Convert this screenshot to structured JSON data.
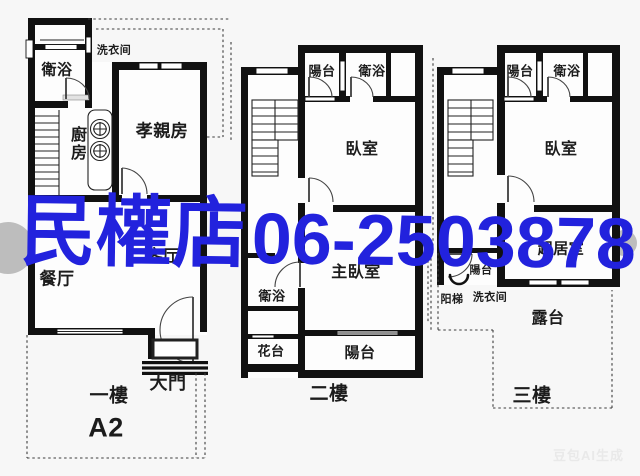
{
  "palette": {
    "wall": "#111111",
    "background": "#f7f7f7",
    "room": "#fdfdfd",
    "watermark_blue": "#2222dd",
    "ai_badge_gray": "#e9e9e9"
  },
  "watermark": {
    "store": "民權店",
    "phone": "06-2503878",
    "color": "#2222dd"
  },
  "ai_badge": {
    "text": "豆包AI生成"
  },
  "floors": [
    {
      "title": "一樓",
      "unit": "A2",
      "rooms": {
        "laundry": "洗衣间",
        "bath": "衛浴",
        "kitchen": "廚房",
        "parents_room": "孝親房",
        "living": "客厅",
        "dining": "餐厅",
        "main_door": "大門"
      }
    },
    {
      "title": "二樓",
      "rooms": {
        "balcony_top": "陽台",
        "bath_top": "衛浴",
        "bedroom": "臥室",
        "master_bedroom": "主臥室",
        "bath": "衛浴",
        "flower_bed": "花台",
        "balcony": "陽台"
      }
    },
    {
      "title": "三樓",
      "rooms": {
        "balcony_top": "陽台",
        "bath": "衛浴",
        "bedroom": "臥室",
        "living_room": "起居室",
        "balcony_small": "陽台",
        "roof_ladder": "阳梯",
        "laundry": "洗衣间",
        "terrace": "露台"
      }
    }
  ]
}
